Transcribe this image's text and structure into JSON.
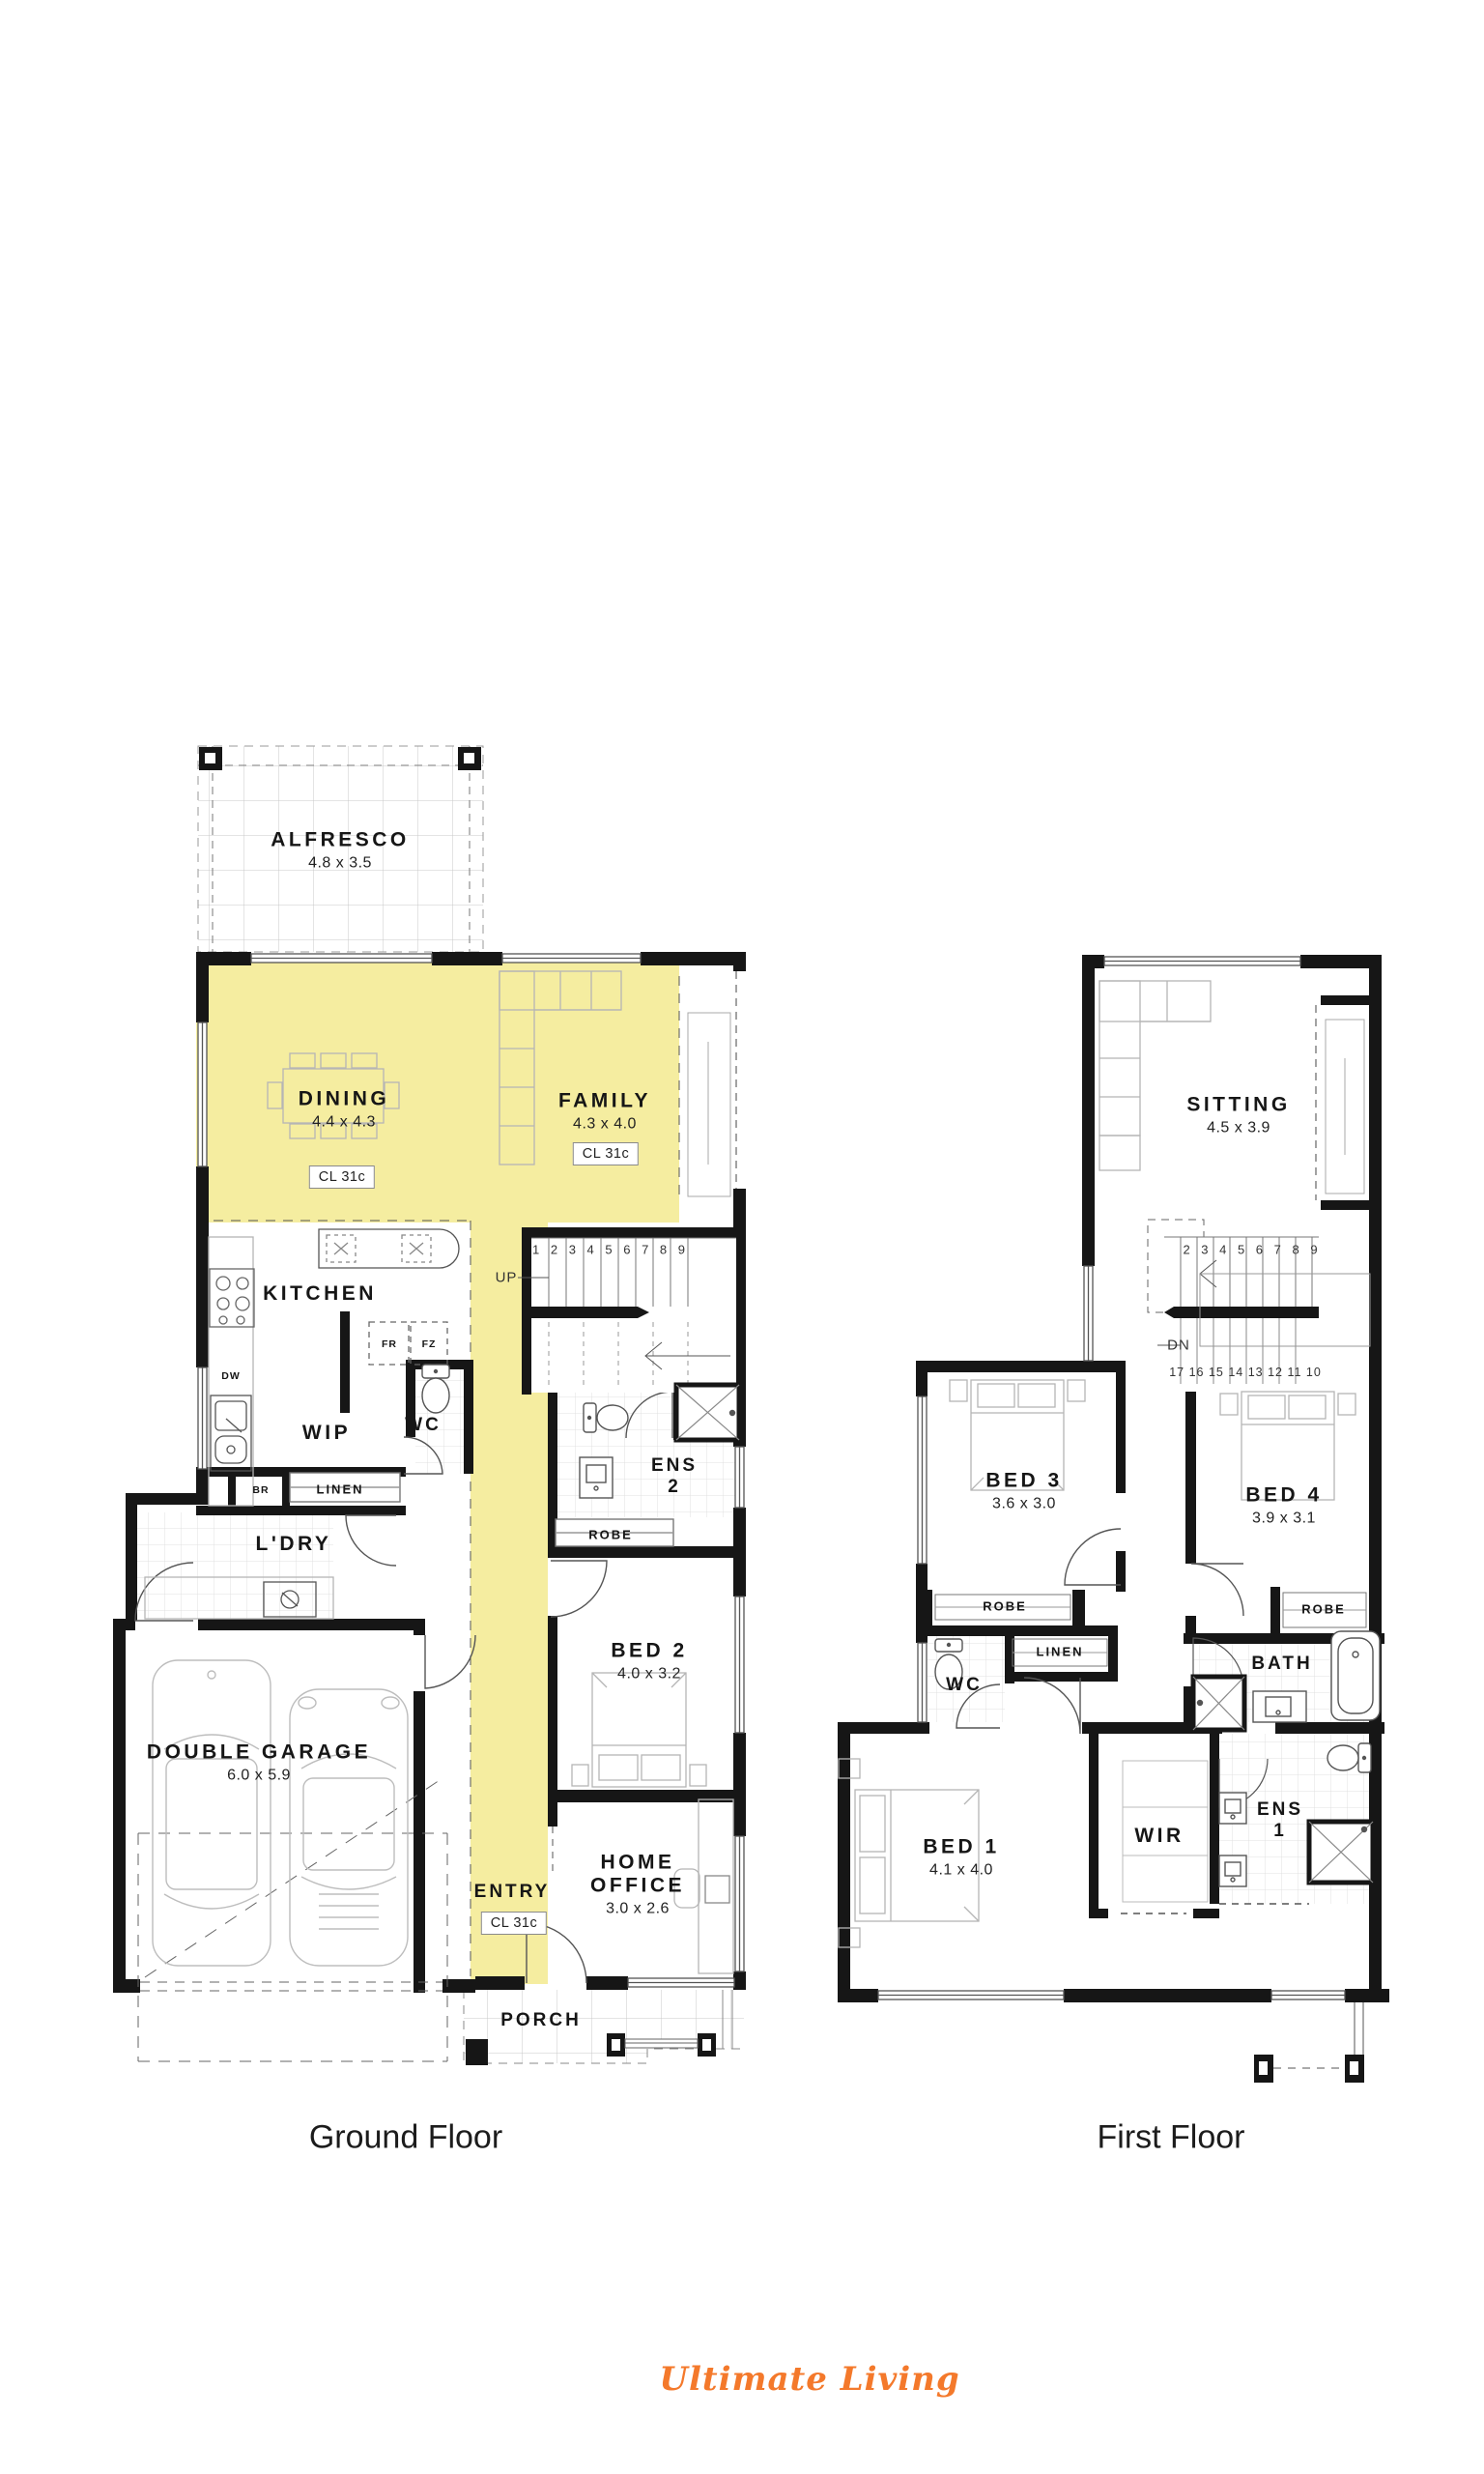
{
  "captions": {
    "ground": "Ground Floor",
    "first": "First Floor"
  },
  "logo": {
    "text": "Ultimate Living",
    "color": "#F4792B"
  },
  "colors": {
    "highlight": "#F5EDA0",
    "wall": "#161616"
  },
  "stairs": {
    "ground": {
      "numbers": "1 2 3 4 5 6 7 8 9",
      "direction": "UP"
    },
    "first": {
      "numbers_top": "2 3 4 5 6 7 8 9",
      "numbers_bottom": "17 16 15 14 13 12 11 10",
      "direction": "DN"
    }
  },
  "ground": {
    "alfresco": {
      "name": "ALFRESCO",
      "dims": "4.8 x 3.5"
    },
    "dining": {
      "name": "DINING",
      "dims": "4.4 x 4.3",
      "ceiling": "CL 31c"
    },
    "family": {
      "name": "FAMILY",
      "dims": "4.3 x 4.0",
      "ceiling": "CL 31c"
    },
    "kitchen": {
      "name": "KITCHEN"
    },
    "wip": {
      "name": "WIP"
    },
    "wc": {
      "name": "WC"
    },
    "ens2": {
      "name": "ENS",
      "number": "2"
    },
    "robe": {
      "name": "ROBE"
    },
    "bed2": {
      "name": "BED 2",
      "dims": "4.0 x 3.2"
    },
    "br": {
      "name": "BR"
    },
    "linen": {
      "name": "LINEN"
    },
    "ldry": {
      "name": "L'DRY"
    },
    "garage": {
      "name": "DOUBLE GARAGE",
      "dims": "6.0 x 5.9"
    },
    "entry": {
      "name": "ENTRY",
      "ceiling": "CL 31c"
    },
    "office": {
      "name": "HOME",
      "name2": "OFFICE",
      "dims": "3.0 x 2.6"
    },
    "porch": {
      "name": "PORCH"
    },
    "appliances": {
      "dw": "DW",
      "fr": "FR",
      "fz": "FZ"
    }
  },
  "first": {
    "sitting": {
      "name": "SITTING",
      "dims": "4.5 x 3.9"
    },
    "bed3": {
      "name": "BED 3",
      "dims": "3.6 x 3.0"
    },
    "bed4": {
      "name": "BED 4",
      "dims": "3.9 x 3.1"
    },
    "robe3": {
      "name": "ROBE"
    },
    "robe4": {
      "name": "ROBE"
    },
    "linen": {
      "name": "LINEN"
    },
    "wc": {
      "name": "WC"
    },
    "bath": {
      "name": "BATH"
    },
    "bed1": {
      "name": "BED 1",
      "dims": "4.1 x 4.0"
    },
    "wir": {
      "name": "WIR"
    },
    "ens1": {
      "name": "ENS",
      "number": "1"
    }
  }
}
